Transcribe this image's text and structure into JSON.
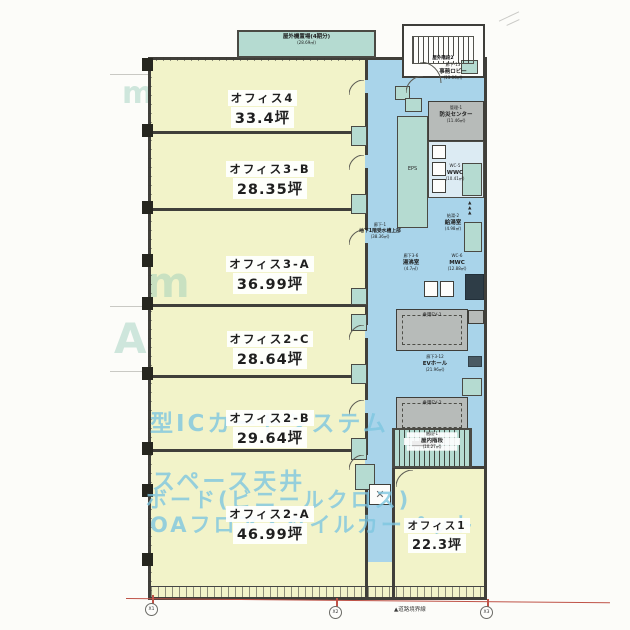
{
  "offices": [
    {
      "name": "オフィス4",
      "area": "33.4坪"
    },
    {
      "name": "オフィス3-B",
      "area": "28.35坪"
    },
    {
      "name": "オフィス3-A",
      "area": "36.99坪"
    },
    {
      "name": "オフィス2-C",
      "area": "28.64坪"
    },
    {
      "name": "オフィス2-B",
      "area": "29.64坪"
    },
    {
      "name": "オフィス2-A",
      "area": "46.99坪"
    },
    {
      "name": "オフィス1",
      "area": "22.3坪"
    }
  ],
  "service": {
    "roof_unit": {
      "name": "屋外機置場(4期分)",
      "area": "(28.69㎡)"
    },
    "outdoor_stair": {
      "name": "屋外階段2"
    },
    "lobby": {
      "code": "廊下-13",
      "name": "事務ロビー",
      "area": "(13.06㎡)"
    },
    "security": {
      "code": "管理-1",
      "name": "防災センター",
      "area": "(11.46㎡)"
    },
    "wwc": {
      "code": "WC-5",
      "name": "WWC",
      "area": "(10.41㎡)"
    },
    "eps": {
      "name": "EPS"
    },
    "corridor": {
      "code": "廊下-1",
      "name": "地下1階受水槽上部",
      "area": "(38.36㎡)"
    },
    "kyuto": {
      "code": "給湯-2",
      "name": "給湯室",
      "area": "(4.98㎡)"
    },
    "yuwakashi": {
      "code": "廊下3-6",
      "name": "湯沸室",
      "area": "(4.7㎡)"
    },
    "mwc": {
      "code": "WC-6",
      "name": "MWC",
      "area": "(12.88㎡)"
    },
    "ev1": {
      "name": "乗用EV-1"
    },
    "ev_hall": {
      "code": "廊下3-12",
      "name": "EVホール",
      "area": "(21.96㎡)"
    },
    "ev2": {
      "name": "乗用EV-2"
    },
    "indoor_stair": {
      "code": "階段-1",
      "name": "屋内階段",
      "area": "(10.27㎡)"
    },
    "vent_marks": "▲▲▲",
    "pump_mark": "✕"
  },
  "watermark": {
    "lines": [
      "型ICカードシステム",
      "スペース天井",
      "ボード(ビニールクロス)",
      "OAフロア・タイルカーペット"
    ],
    "letters": [
      "m",
      "m",
      "A"
    ]
  },
  "annotations": {
    "road_boundary": "▲道路境界線",
    "grid_markers": [
      "X1",
      "X2",
      "X3"
    ]
  },
  "colors": {
    "office_fill": "#f2f3c9",
    "corridor_fill": "#a9d4ea",
    "service_fill": "#b5dbd1",
    "machine_fill": "#b7bbb9",
    "wall": "#403f3a",
    "watermark": "#7dc6e0",
    "road_line": "#bf5348"
  }
}
